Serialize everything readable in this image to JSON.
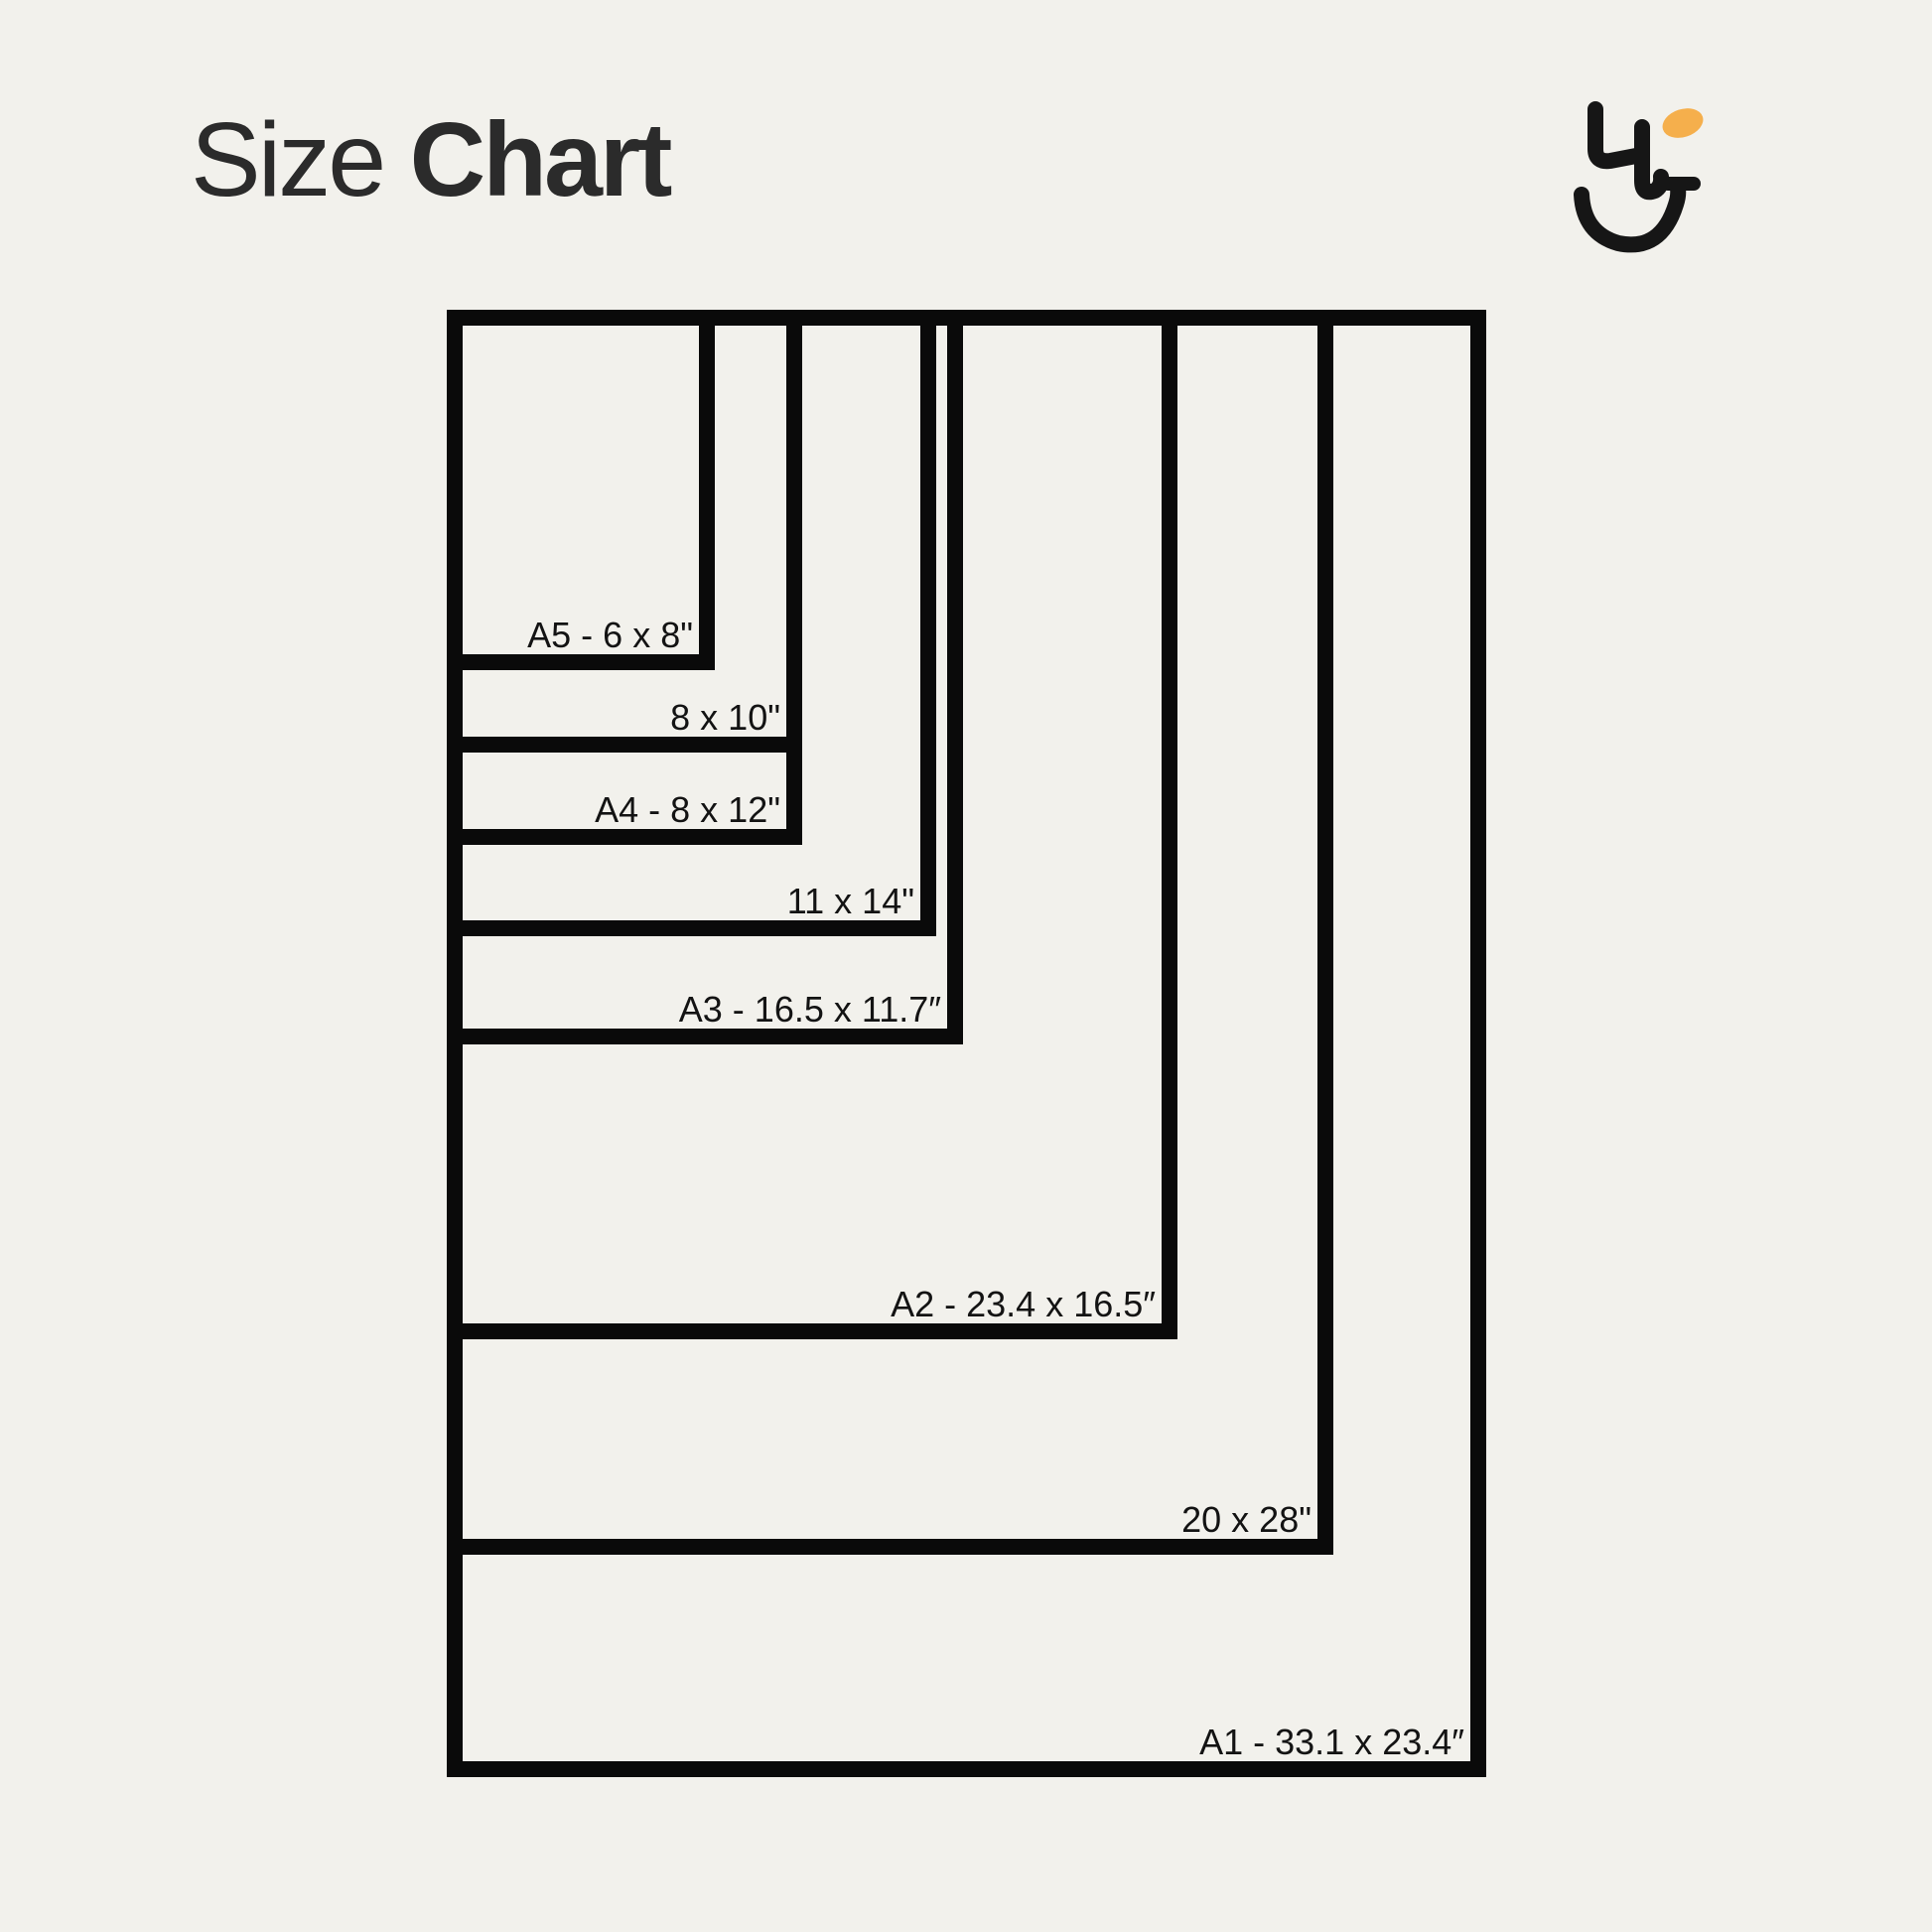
{
  "page": {
    "background_color": "#F2F1EC"
  },
  "header": {
    "title_regular": "Size",
    "title_bold": "Chart",
    "title_color": "#2B2B2B"
  },
  "logo": {
    "icon": "smiley-hu-monogram-icon",
    "mark_color": "#161616",
    "accent_color": "#F5AF4C"
  },
  "chart": {
    "stroke_color": "#0A0A0A",
    "label_color": "#131313",
    "unit": "inches",
    "sizes": [
      {
        "id": "A1",
        "label": "A1 - 33.1 x 23.4″",
        "dimensions_in": "33.1 x 23.4"
      },
      {
        "id": "20x28",
        "label": "20 x 28\"",
        "dimensions_in": "20 x 28"
      },
      {
        "id": "A2",
        "label": "A2 - 23.4 x 16.5″",
        "dimensions_in": "23.4 x 16.5"
      },
      {
        "id": "A3",
        "label": "A3 - 16.5 x 11.7″",
        "dimensions_in": "16.5 x 11.7"
      },
      {
        "id": "11x14",
        "label": "11 x 14\"",
        "dimensions_in": "11 x 14"
      },
      {
        "id": "A4",
        "label": "A4 - 8 x 12\"",
        "dimensions_in": "8 x 12"
      },
      {
        "id": "8x10",
        "label": "8 x 10\"",
        "dimensions_in": "8 x 10"
      },
      {
        "id": "A5",
        "label": "A5 - 6 x 8\"",
        "dimensions_in": "6 x 8"
      }
    ]
  }
}
